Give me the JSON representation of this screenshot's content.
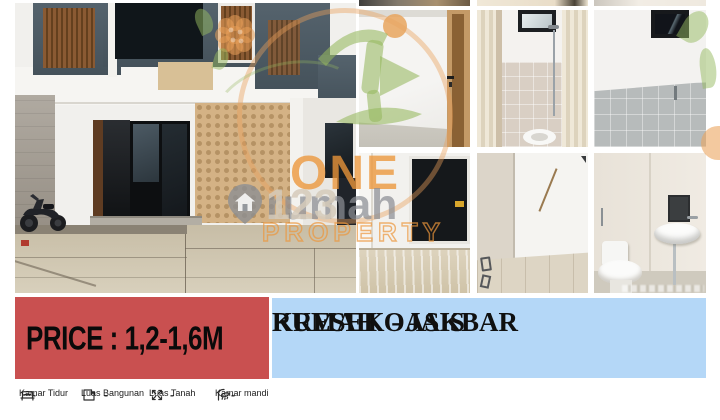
{
  "price_banner": {
    "text": "PRICE : 1,2-1,6M",
    "bg_color": "#c95050",
    "text_color": "#0a0a0a"
  },
  "title_banner": {
    "line1": "RUMAH OASIS",
    "line2": "KRESEK - JAKBAR",
    "bg_color": "#b4d7f7",
    "text_color": "#101010"
  },
  "watermark": {
    "brand_word_1": "ONE",
    "brand_word_2": "PROPERTY",
    "portal_name": "rumah",
    "portal_digits": "123",
    "logo_icons": [
      "leaf-person-house-icon",
      "sun-circle-icon",
      "orange-ring-icon",
      "flower-icon",
      "map-pin-house-icon"
    ],
    "orange": "#e89a4d",
    "green": "#96b95e",
    "gray": "#8d9094"
  },
  "features": [
    {
      "icon": "bed-icon",
      "label": "Kamar Tidur",
      "value": "-"
    },
    {
      "icon": "floorplan-icon",
      "label": "Luas Bangunan",
      "value": "-"
    },
    {
      "icon": "expand-arrows-icon",
      "label": "Luas Tanah",
      "value": "-"
    },
    {
      "icon": "shower-icon",
      "label": "Kamar mandi",
      "value": "-"
    }
  ],
  "photos": {
    "main": "two-story house exterior with driveway and motorcycle",
    "grid": [
      "bedroom corner with wooden door",
      "bathroom with shower, window and curtains",
      "bathroom with gray tile wainscot",
      "room with black-framed window and glossy floor",
      "empty room with tiled floor",
      "bathroom with toilet and wall sink"
    ]
  }
}
